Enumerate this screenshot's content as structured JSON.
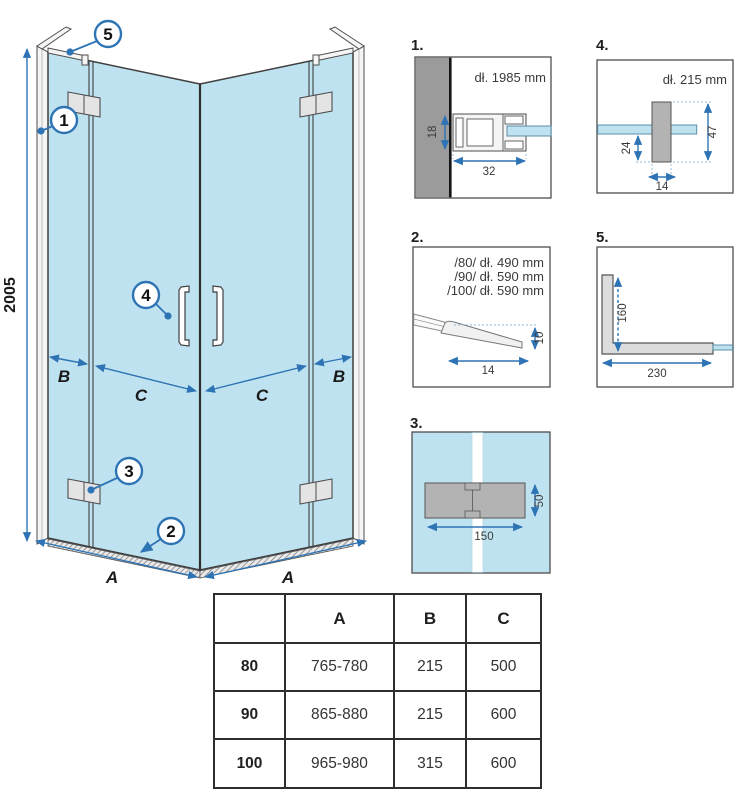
{
  "drawing": {
    "height_dim": "2005",
    "label_a": "A",
    "label_b": "B",
    "label_c": "C",
    "callout_1": "1",
    "callout_2": "2",
    "callout_3": "3",
    "callout_4": "4",
    "callout_5": "5"
  },
  "details": {
    "d1": {
      "number": "1.",
      "title": "dł. 1985 mm",
      "dim_18": "18",
      "dim_32": "32"
    },
    "d2": {
      "number": "2.",
      "line_80": "/80/ dł. 490 mm",
      "line_90": "/90/ dł. 590 mm",
      "line_100": "/100/ dł. 590 mm",
      "dim_14": "14",
      "dim_10": "10"
    },
    "d3": {
      "number": "3.",
      "dim_150": "150",
      "dim_50": "50"
    },
    "d4": {
      "number": "4.",
      "title": "dł. 215 mm",
      "dim_24": "24",
      "dim_47": "47",
      "dim_14": "14"
    },
    "d5": {
      "number": "5.",
      "dim_160": "160",
      "dim_230": "230"
    }
  },
  "table": {
    "header": {
      "col0": "",
      "col1": "A",
      "col2": "B",
      "col3": "C"
    },
    "rows": [
      {
        "size": "80",
        "a": "765-780",
        "b": "215",
        "c": "500"
      },
      {
        "size": "90",
        "a": "865-880",
        "b": "215",
        "c": "600"
      },
      {
        "size": "100",
        "a": "965-980",
        "b": "315",
        "c": "600"
      }
    ]
  },
  "colors": {
    "glass_blue": "#bfe2f0",
    "dimension_blue": "#2e74b5",
    "wall_gray": "#9b9b9b",
    "part_gray": "#b3b3b3"
  }
}
